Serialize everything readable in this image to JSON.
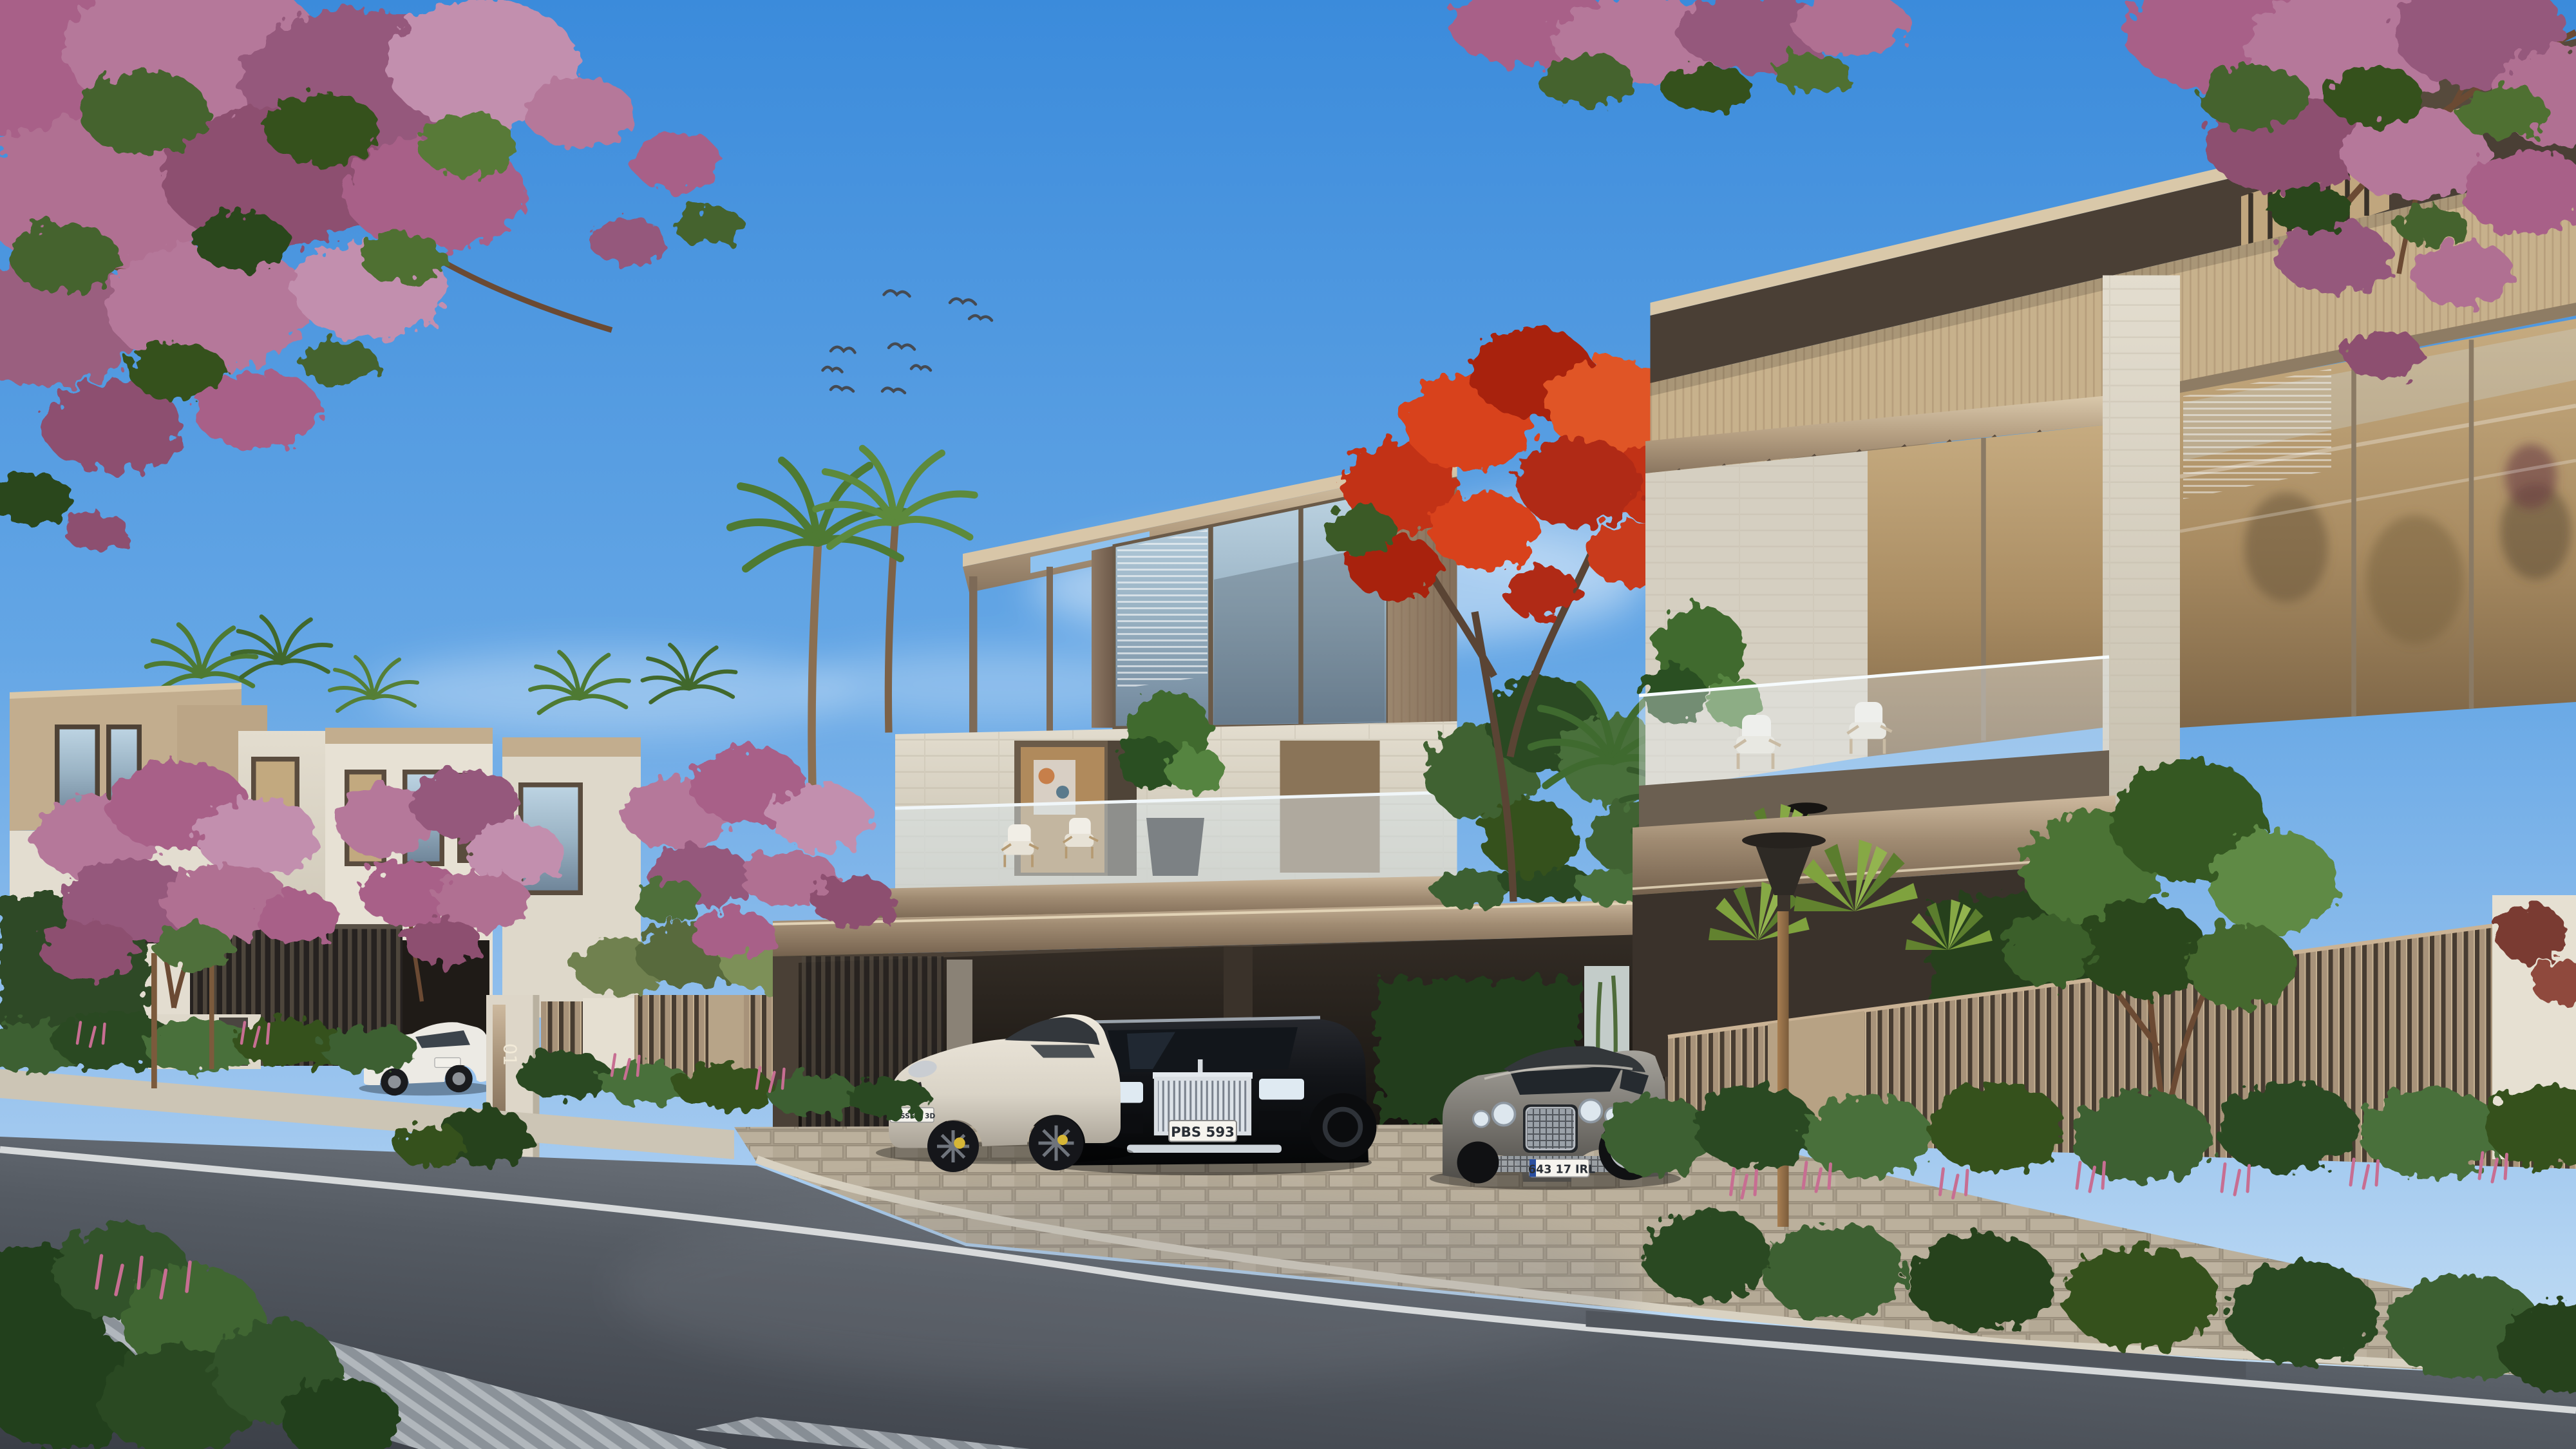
{
  "scene": {
    "description": "Daytime architectural render of a modern luxury villa street: beige and stone villas, carports with luxury cars, pink flowering trees, palms, hedges and a clear blue sky with a small flock of birds"
  },
  "signage": {
    "near_gate_number": "01",
    "far_gate_number": "01"
  },
  "vehicles": {
    "porsche_plate": "HOSSEIN 3D",
    "rolls_royce_plate": "PBS 593",
    "bentley_plate": "643 17 IRL"
  },
  "birds": {
    "count": 9
  },
  "palette": {
    "sky_top": "#3B8BDB",
    "sky_horizon": "#CFE5F6",
    "blossom_pink": "#B5789A",
    "flame_tree_red": "#C23019",
    "villa_bronze": "#8A7663",
    "villa_stone": "#D7D1C3",
    "fence_bronze": "#A8937A",
    "asphalt": "#4A4F57",
    "paver": "#B0A592",
    "hedge_green": "#3C6130"
  }
}
